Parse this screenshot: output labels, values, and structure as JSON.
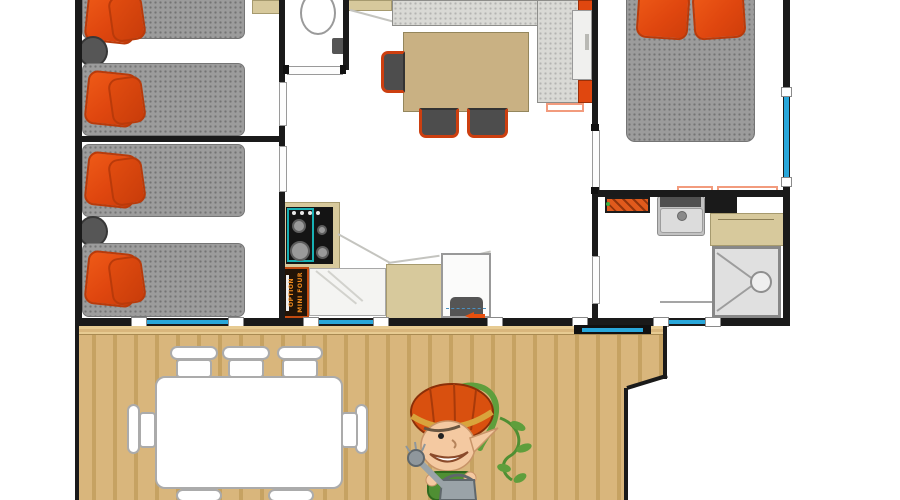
{
  "labels": {
    "kitchen_option_line1": "OPTION",
    "kitchen_option_line2": "MINI FOUR"
  },
  "colors": {
    "wall": "#1a1a1a",
    "mattress": "#9c9c9c",
    "sofa": "#d9d9d5",
    "pillow": "#e0470f",
    "pillow-dark": "#b93a0a",
    "tan": "#c9b183",
    "cabinet": "#d7c99c",
    "window": "#29a7da",
    "salmon": "#f29b7d",
    "radiator": "#e05a1c",
    "teal": "#17b1b4",
    "chair-frame": "#cc3f10",
    "wood": "#d9b67c",
    "wood-dark": "#c6a262",
    "wood-light": "#e7cb92"
  },
  "legend": {
    "type": "mobile-home floor plan, top view, top of plan cropped",
    "rooms_left_to_right": [
      "twin bedroom (2 single beds)",
      "twin bedroom (2 single beds)",
      "WC",
      "living-dining",
      "kitchen",
      "master bedroom (double bed)",
      "bathroom with shower",
      "wooden deck with outdoor table and mascot"
    ],
    "single_beds": 4,
    "double_beds": 1,
    "dining_chairs_visible": 3,
    "deck_chairs_visible": 7,
    "windows_blue_on_walls": 4,
    "mascot": "cartoon elf with orange pumpkin helmet holding a watering can"
  }
}
